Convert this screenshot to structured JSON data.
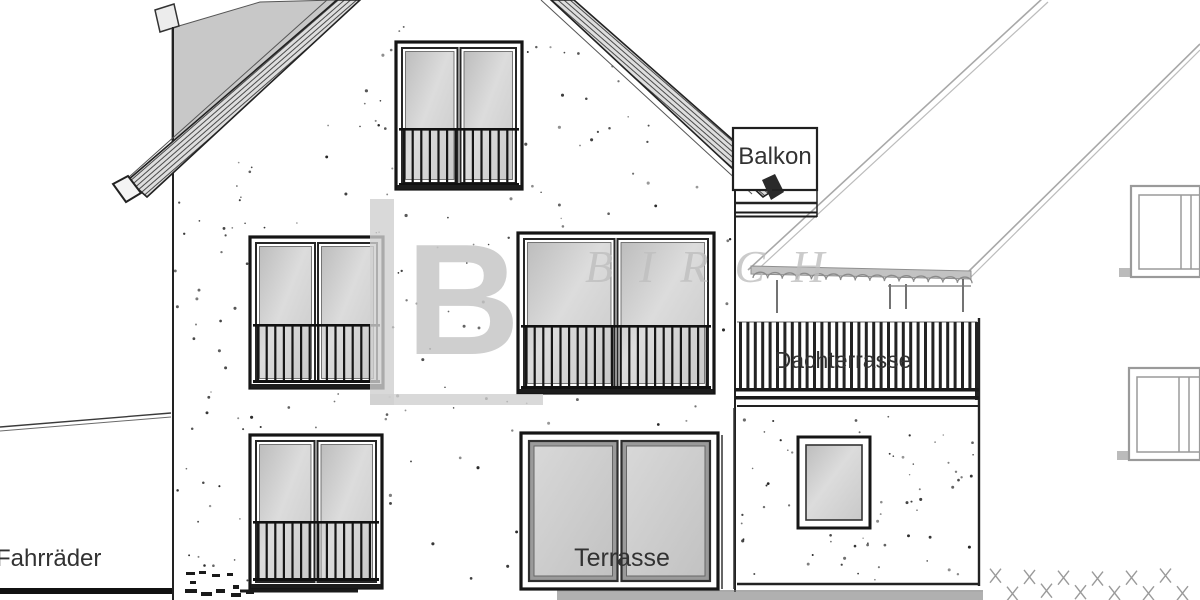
{
  "drawing": {
    "labels": {
      "balkon": "Balkon",
      "dachterrasse": "Dachterrasse",
      "terrasse": "Terrasse",
      "fahrraeder": "Fahrräder"
    },
    "watermark": {
      "initial": "B",
      "brand": "BIRCH"
    },
    "colors": {
      "ink": "#1c1c1c",
      "wall": "#ffffff",
      "roof_shade": "#c8c8c8",
      "glass": "#d0d0d0",
      "neighbor_line": "#a8a8a8",
      "watermark_gray": "#c6c6c6",
      "label_ink": "#333333"
    }
  }
}
